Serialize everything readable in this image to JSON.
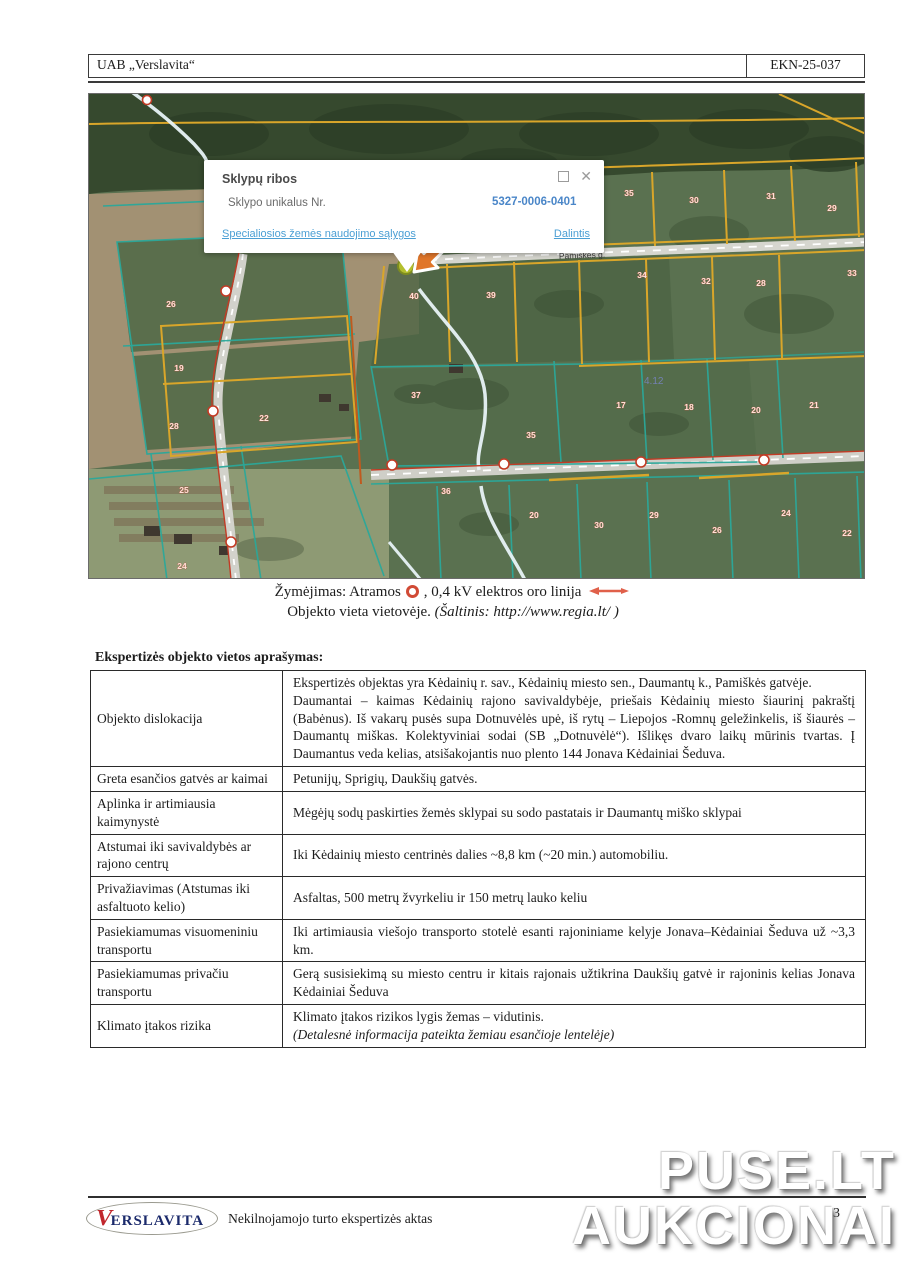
{
  "header": {
    "company": "UAB „Verslavita“",
    "code": "EKN-25-037"
  },
  "map": {
    "popup": {
      "title": "Sklypų ribos",
      "field_label": "Sklypo unikalus Nr.",
      "field_value": "5327-0006-0401",
      "link_conditions": "Specialiosios žemės naudojimo sąlygos",
      "link_share": "Dalintis",
      "close_glyph": "✕"
    },
    "road_label": "Pamiškės g.",
    "area_label": "4.12",
    "parcel_labels": [
      {
        "n": "35",
        "x": 540,
        "y": 102
      },
      {
        "n": "30",
        "x": 605,
        "y": 109
      },
      {
        "n": "31",
        "x": 682,
        "y": 105
      },
      {
        "n": "29",
        "x": 743,
        "y": 117
      },
      {
        "n": "34",
        "x": 553,
        "y": 184
      },
      {
        "n": "32",
        "x": 617,
        "y": 190
      },
      {
        "n": "28",
        "x": 672,
        "y": 192
      },
      {
        "n": "33",
        "x": 763,
        "y": 182
      },
      {
        "n": "40",
        "x": 325,
        "y": 205
      },
      {
        "n": "39",
        "x": 402,
        "y": 204
      },
      {
        "n": "37",
        "x": 327,
        "y": 304
      },
      {
        "n": "17",
        "x": 532,
        "y": 314
      },
      {
        "n": "18",
        "x": 600,
        "y": 316
      },
      {
        "n": "20",
        "x": 667,
        "y": 319
      },
      {
        "n": "21",
        "x": 725,
        "y": 314
      },
      {
        "n": "26",
        "x": 82,
        "y": 213
      },
      {
        "n": "19",
        "x": 90,
        "y": 277
      },
      {
        "n": "28",
        "x": 85,
        "y": 335
      },
      {
        "n": "22",
        "x": 175,
        "y": 327
      },
      {
        "n": "25",
        "x": 95,
        "y": 399
      },
      {
        "n": "24",
        "x": 93,
        "y": 475
      },
      {
        "n": "35",
        "x": 442,
        "y": 344
      },
      {
        "n": "36",
        "x": 357,
        "y": 400
      },
      {
        "n": "20",
        "x": 445,
        "y": 424
      },
      {
        "n": "30",
        "x": 510,
        "y": 434
      },
      {
        "n": "29",
        "x": 565,
        "y": 424
      },
      {
        "n": "26",
        "x": 628,
        "y": 439
      },
      {
        "n": "24",
        "x": 697,
        "y": 422
      },
      {
        "n": "22",
        "x": 758,
        "y": 442
      }
    ],
    "colors": {
      "parcel_teal": "#2ba89a",
      "parcel_orange": "#d9a62a",
      "power_red": "#c23b25",
      "link_blue": "#4b9fd4"
    }
  },
  "caption": {
    "marking_prefix": "Žymėjimas: Atramos",
    "marking_suffix": ", 0,4 kV elektros oro linija",
    "line2": "Objekto vieta vietovėje.",
    "source": "(Šaltinis: http://www.regia.lt/ )"
  },
  "section": {
    "heading": "Ekspertizės objekto vietos aprašymas:",
    "rows": [
      {
        "label": "Objekto dislokacija",
        "p1": "Ekspertizės objektas yra Kėdainių r. sav., Kėdainių miesto sen., Daumantų k., Pamiškės gatvėje.",
        "p2": "Daumantai – kaimas Kėdainių rajono savivaldybėje, priešais Kėdainių miesto šiaurinį pakraštį (Babėnus). Iš vakarų pusės supa Dotnuvėlės upė, iš rytų – Liepojos -Romnų geležinkelis, iš šiaurės – Daumantų miškas. Kolektyviniai sodai (SB „Dotnuvėlė“). Išlikęs dvaro laikų mūrinis tvartas. Į Daumantus veda kelias, atsišakojantis nuo plento 144 Jonava Kėdainiai Šeduva."
      },
      {
        "label": "Greta esančios gatvės ar kaimai",
        "p1": "Petunijų, Sprigių, Daukšių gatvės."
      },
      {
        "label": "Aplinka ir artimiausia kaimynystė",
        "p1": "Mėgėjų sodų paskirties žemės sklypai su sodo pastatais ir Daumantų miško sklypai"
      },
      {
        "label": "Atstumai iki savivaldybės ar rajono centrų",
        "p1": "Iki Kėdainių miesto centrinės dalies ~8,8 km (~20 min.) automobiliu."
      },
      {
        "label": "Privažiavimas (Atstumas iki asfaltuoto kelio)",
        "p1": "Asfaltas, 500 metrų žvyrkeliu ir 150 metrų lauko keliu"
      },
      {
        "label": "Pasiekiamumas visuomeniniu transportu",
        "p1": "Iki artimiausia viešojo transporto stotelė esanti rajoniniame kelyje Jonava–Kėdainiai Šeduva už ~3,3 km."
      },
      {
        "label": "Pasiekiamumas privačiu transportu",
        "p1": "Gerą susisiekimą su miesto centru ir kitais rajonais užtikrina Daukšių gatvė ir rajoninis kelias Jonava Kėdainiai Šeduva"
      },
      {
        "label": "Klimato įtakos rizika",
        "p1": "Klimato įtakos rizikos lygis žemas – vidutinis.",
        "p2": "(Detalesnė informacija pateikta žemiau esančioje lentelėje)"
      }
    ]
  },
  "footer": {
    "logo_v": "V",
    "logo_rest": "ERSLAVITA",
    "text": "Nekilnojamojo turto ekspertizės aktas",
    "page": "13"
  },
  "watermark": {
    "line1": "PUSE.LT",
    "line2": "AUKCIONAI"
  }
}
